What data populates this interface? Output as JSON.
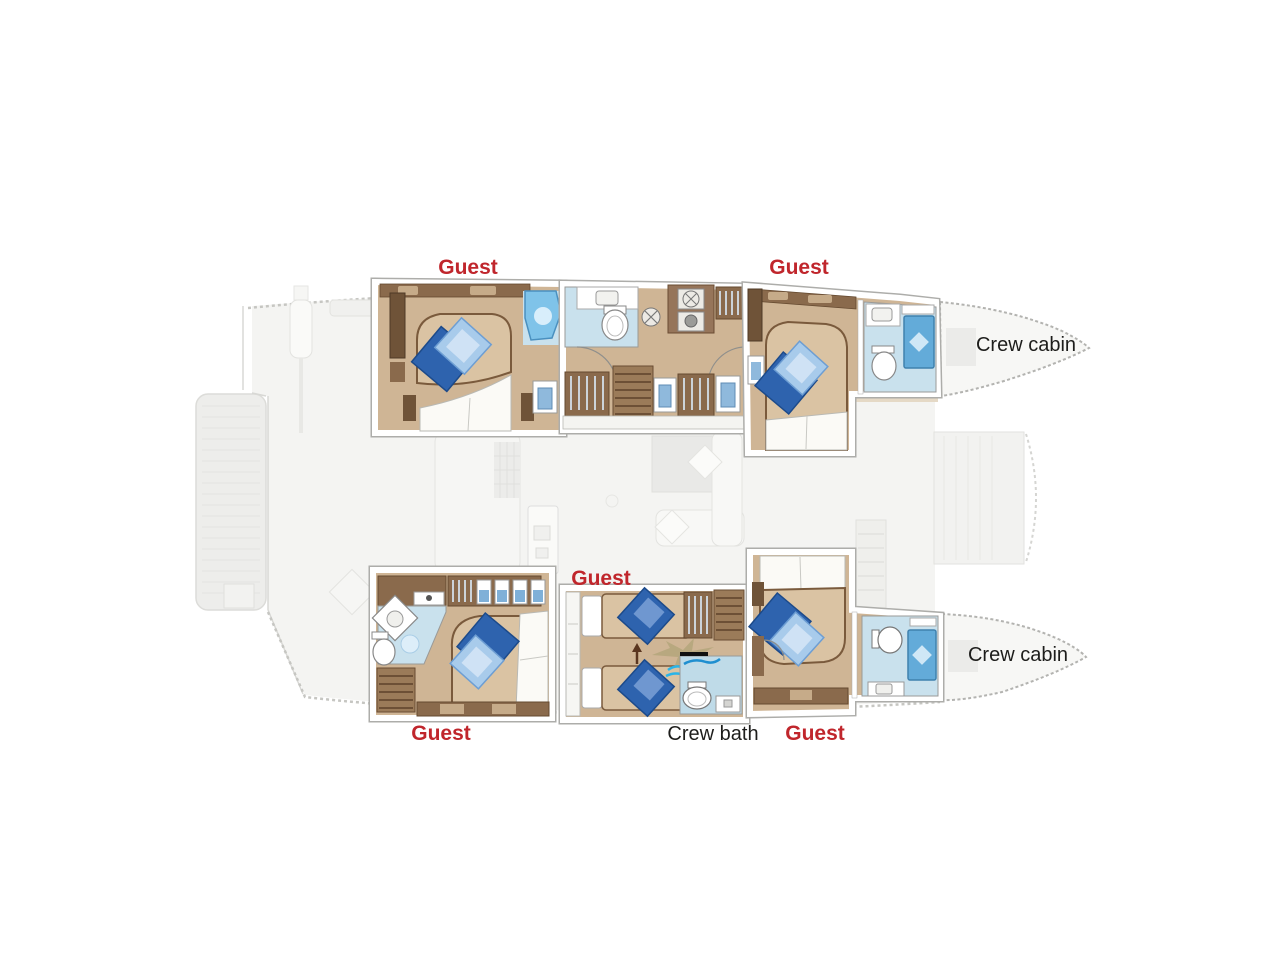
{
  "labels": {
    "guest_top_left": "Guest",
    "guest_top_right": "Guest",
    "guest_mid": "Guest",
    "guest_bottom_left": "Guest",
    "guest_bottom_right": "Guest",
    "crew_cabin_top": "Crew cabin",
    "crew_cabin_bottom": "Crew cabin",
    "crew_bath": "Crew bath"
  },
  "colors": {
    "label_red": "#c0262c",
    "label_black": "#1d1d1b",
    "floor_tan": "#cfb595",
    "wood_dark": "#6f5338",
    "wood_mid": "#8a6a4c",
    "wood_light": "#9b7b59",
    "bath_floor_blue": "#c9e1ed",
    "shower_blue": "#63abd9",
    "shower_bright": "#7fc3e9",
    "pillow_dark_blue": "#2e63ae",
    "pillow_light_blue": "#a8cbeb",
    "linen_white": "#fbfaf6",
    "faded_deck": "#f4f4f2",
    "annotation_khaki": "#b5a67c",
    "annotation_cyan": "#2ab4e8"
  }
}
